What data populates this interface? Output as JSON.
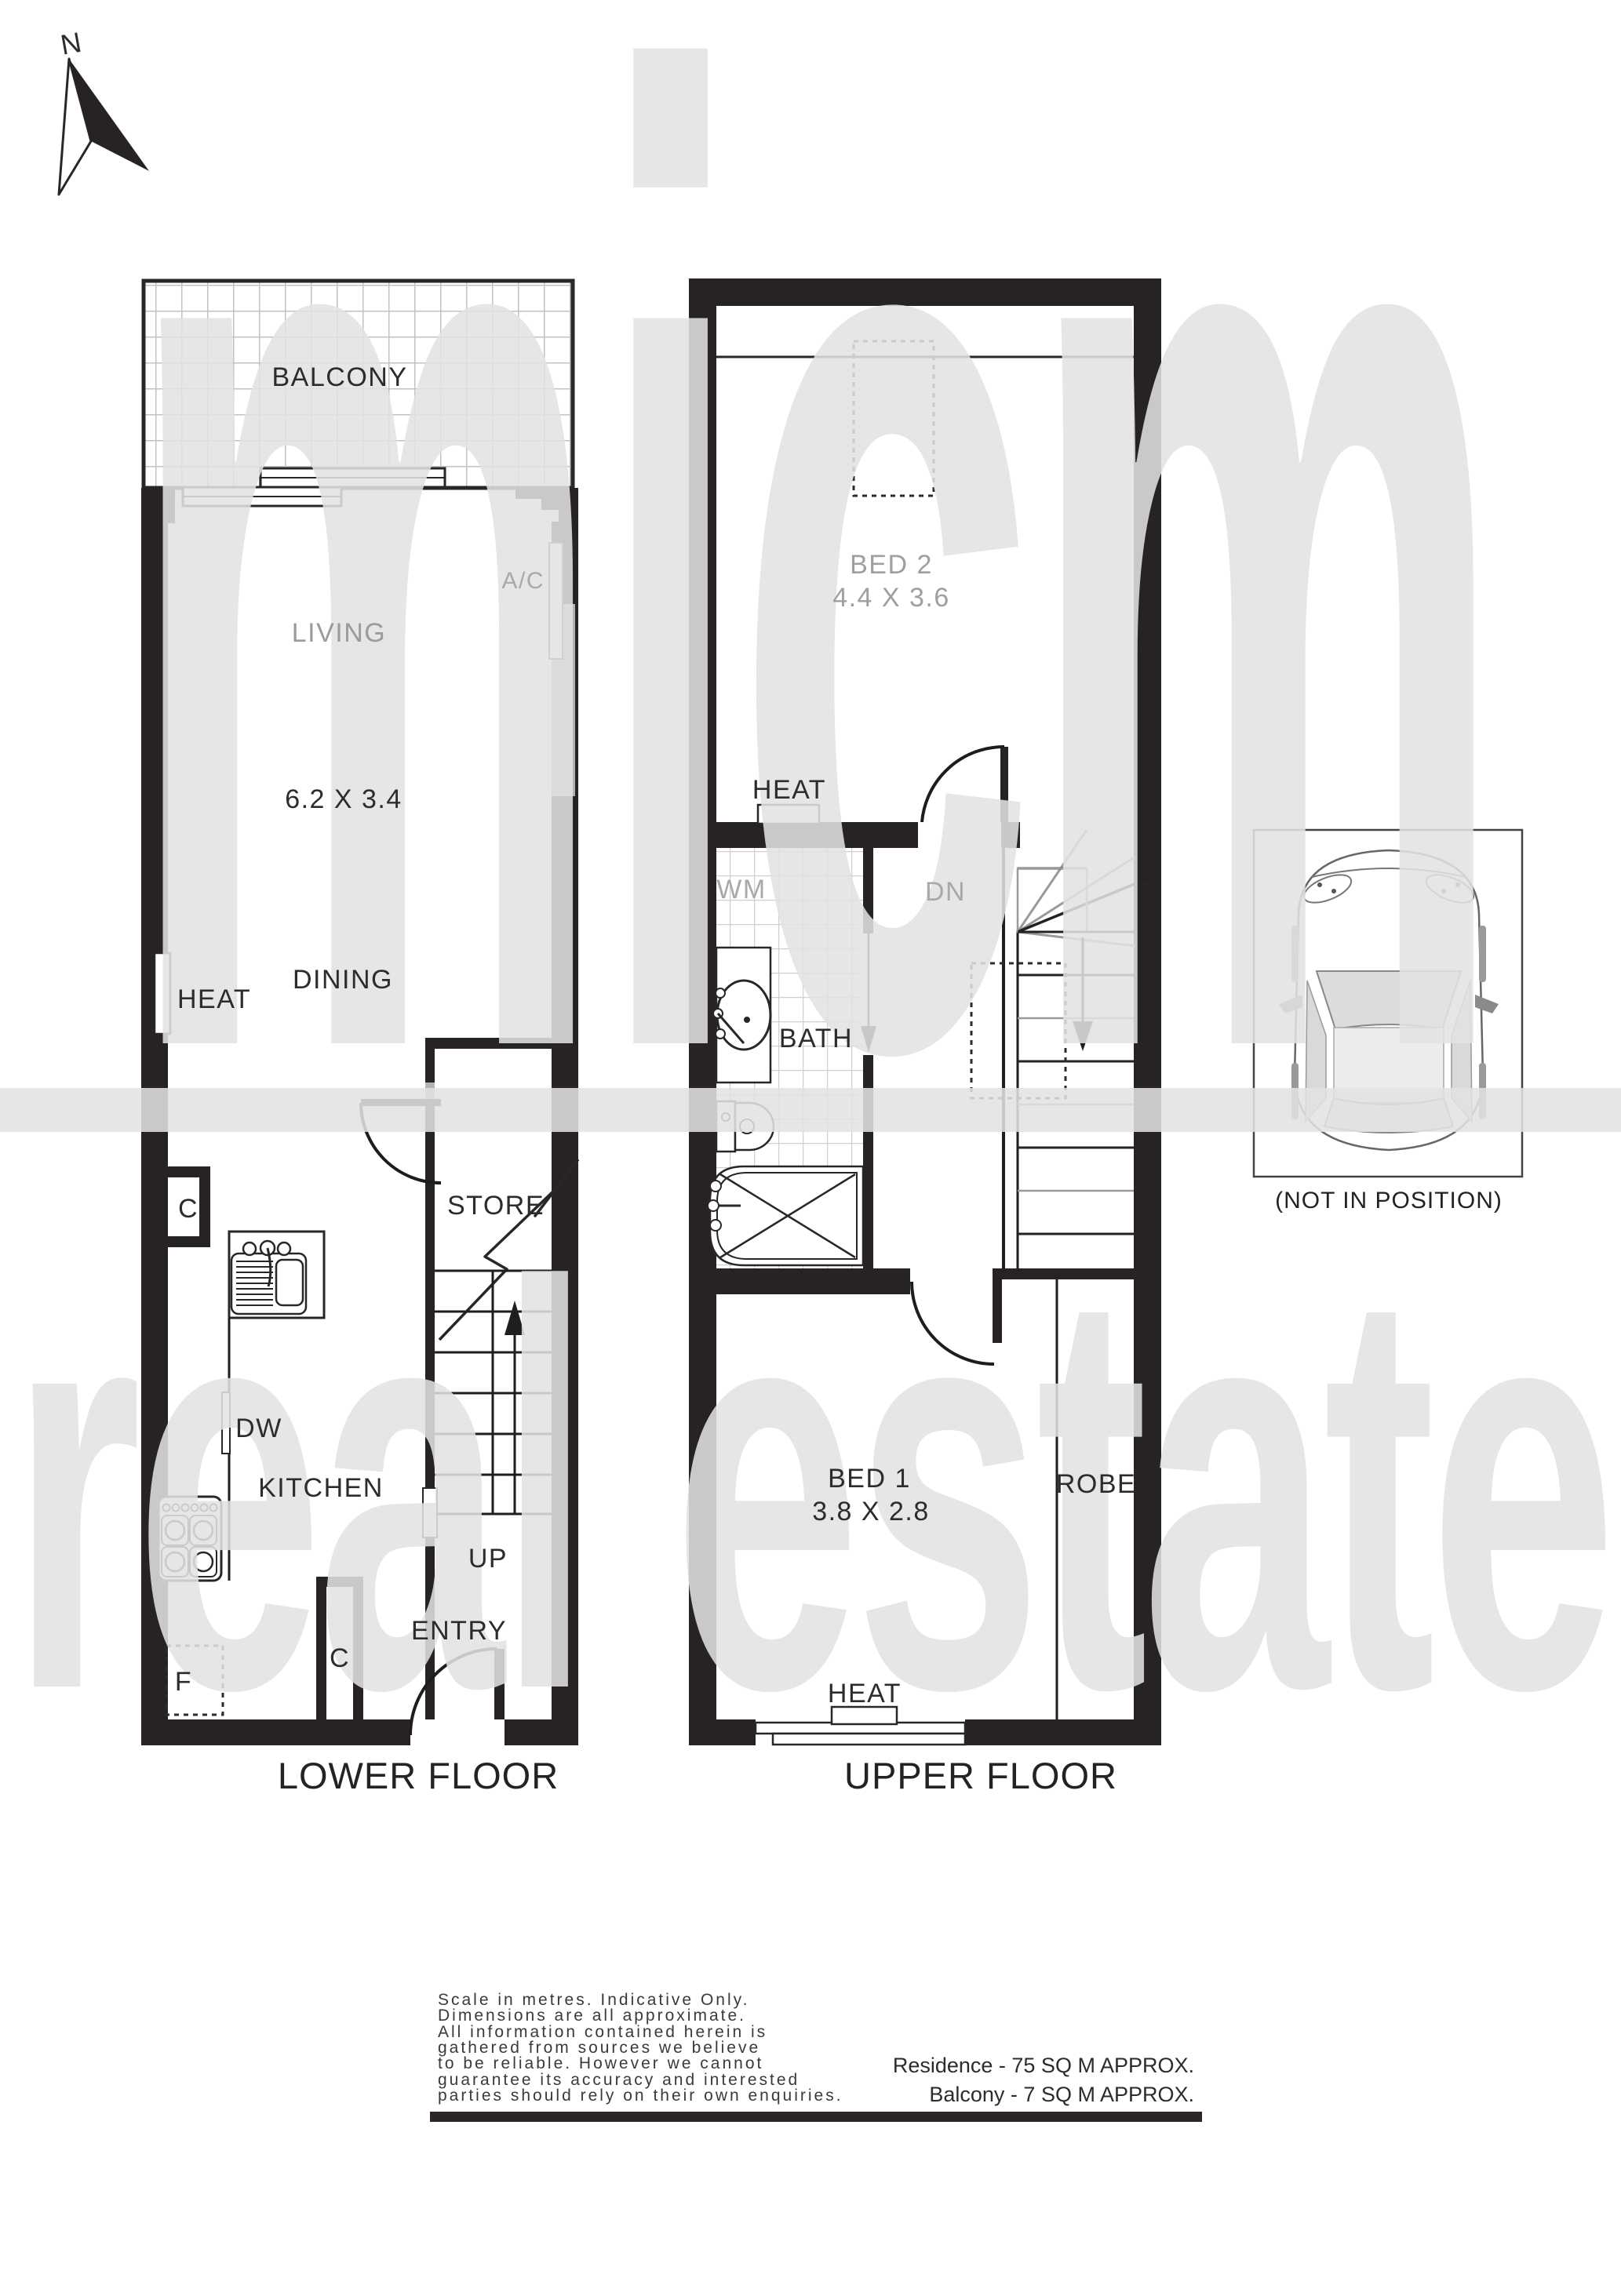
{
  "compass": {
    "n": "N"
  },
  "watermark": {
    "word1": "micm",
    "word2": "real estate",
    "color": "#e4e4e4"
  },
  "lower_floor": {
    "title": "LOWER FLOOR",
    "balcony_label": "BALCONY",
    "living_label": "LIVING",
    "living_dims": "6.2 X 3.4",
    "ac_label": "A/C",
    "heat_label": "HEAT",
    "dining_label": "DINING",
    "store_label": "STORE",
    "dw_label": "DW",
    "kitchen_label": "KITCHEN",
    "up_label": "UP",
    "entry_label": "ENTRY",
    "closet1_label": "C",
    "closet2_label": "C",
    "fridge_label": "F"
  },
  "upper_floor": {
    "title": "UPPER FLOOR",
    "bed2_label": "BED 2",
    "bed2_dims": "4.4 X 3.6",
    "heat_top_label": "HEAT",
    "wm_label": "WM",
    "dn_label": "DN",
    "bath_label": "BATH",
    "bed1_label": "BED 1",
    "bed1_dims": "3.8 X 2.8",
    "robe_label": "ROBE",
    "heat_bottom_label": "HEAT"
  },
  "car_space": {
    "note": "(NOT IN POSITION)"
  },
  "footer": {
    "disclaimer_lines": [
      "Scale in metres. Indicative Only.",
      "Dimensions are all approximate.",
      "All information contained herein is",
      "gathered from sources we believe",
      "to be reliable. However we cannot",
      "guarantee its accuracy and interested",
      "parties should rely on their own enquiries."
    ],
    "residence_area": "Residence -  75 SQ M APPROX.",
    "balcony_area": "Balcony -  7 SQ M APPROX."
  },
  "colors": {
    "wall": "#272324",
    "label": "#2e2b2c",
    "muted_label": "#a9a9a9",
    "tile_line": "#c2c2c2",
    "watermark": "#e4e4e4"
  }
}
